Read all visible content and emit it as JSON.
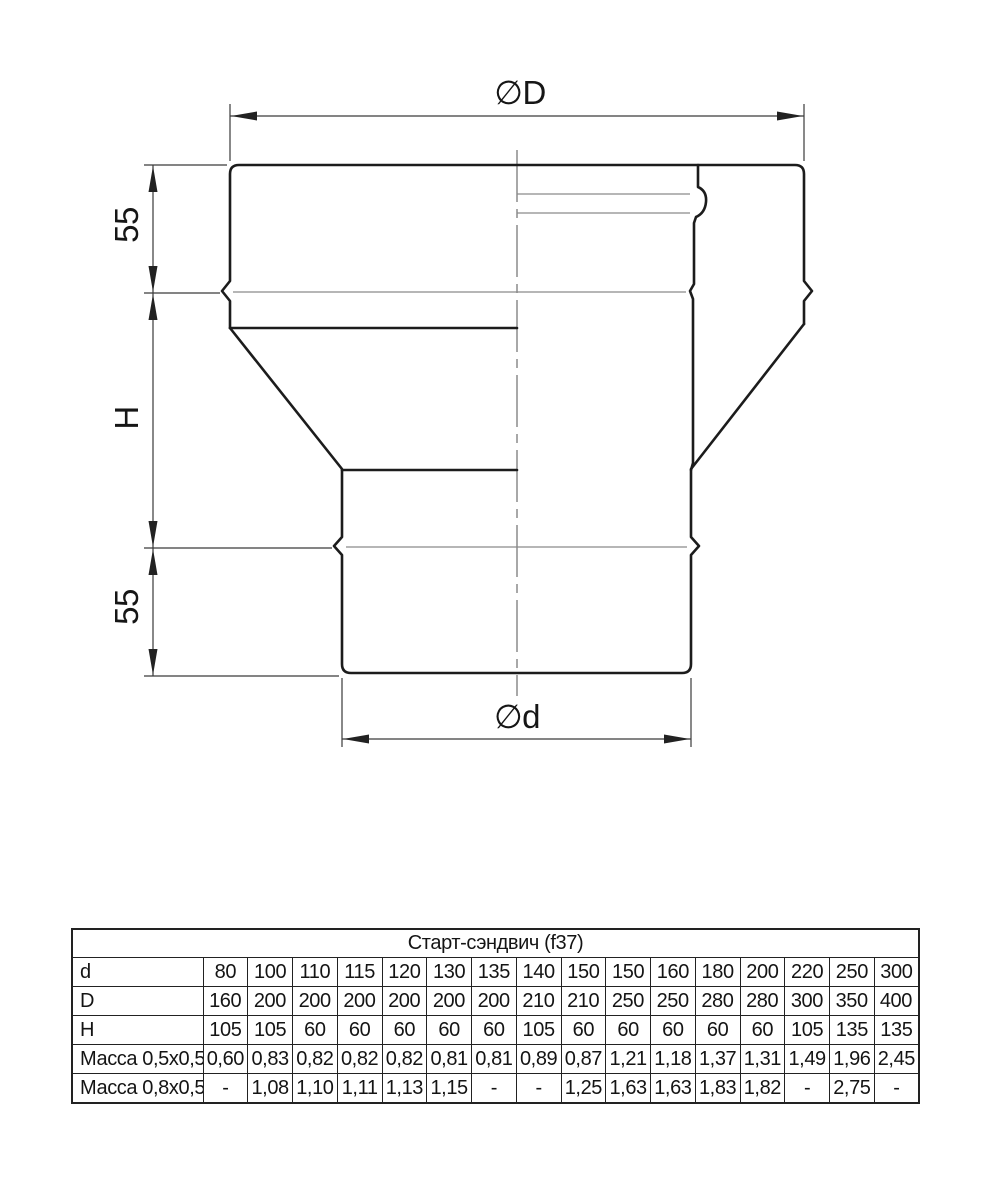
{
  "drawing": {
    "labels": {
      "outer_diameter": "∅D",
      "inner_diameter": "∅d",
      "top_height": "55",
      "middle_height": "H",
      "bottom_height": "55"
    }
  },
  "table": {
    "title": "Старт-сэндвич (f37)",
    "rows": [
      {
        "id": "d",
        "label": "d",
        "align": "center",
        "values": [
          "80",
          "100",
          "110",
          "115",
          "120",
          "130",
          "135",
          "140",
          "150",
          "150",
          "160",
          "180",
          "200",
          "220",
          "250",
          "300"
        ]
      },
      {
        "id": "D",
        "label": "D",
        "align": "right",
        "values": [
          "160",
          "200",
          "200",
          "200",
          "200",
          "200",
          "200",
          "210",
          "210",
          "250",
          "250",
          "280",
          "280",
          "300",
          "350",
          "400"
        ]
      },
      {
        "id": "H",
        "label": "H",
        "align": "center",
        "values": [
          "105",
          "105",
          "60",
          "60",
          "60",
          "60",
          "60",
          "105",
          "60",
          "60",
          "60",
          "60",
          "60",
          "105",
          "135",
          "135"
        ]
      },
      {
        "id": "m05",
        "label": "Масса 0,5x0,5",
        "align": "center",
        "values": [
          "0,60",
          "0,83",
          "0,82",
          "0,82",
          "0,82",
          "0,81",
          "0,81",
          "0,89",
          "0,87",
          "1,21",
          "1,18",
          "1,37",
          "1,31",
          "1,49",
          "1,96",
          "2,45"
        ]
      },
      {
        "id": "m08",
        "label": "Масса 0,8x0,5",
        "align": "center",
        "values": [
          "-",
          "1,08",
          "1,10",
          "1,11",
          "1,13",
          "1,15",
          "-",
          "-",
          "1,25",
          "1,63",
          "1,63",
          "1,83",
          "1,82",
          "-",
          "2,75",
          "-"
        ]
      }
    ]
  }
}
